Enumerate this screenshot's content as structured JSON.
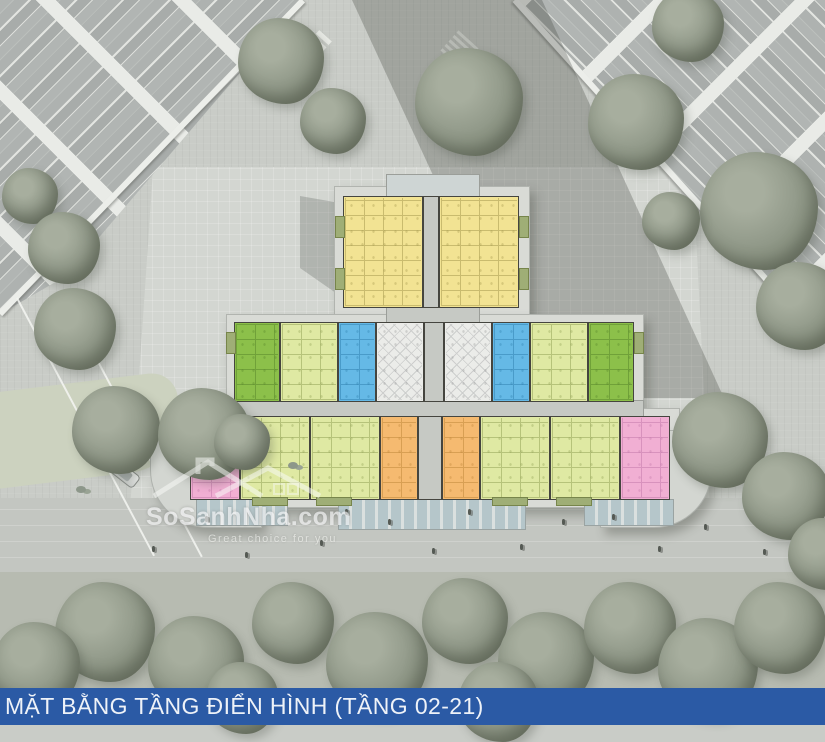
{
  "image_type": "architectural site plan rendering (aerial view)",
  "caption": {
    "label": "MẶT BẰNG TẦNG ĐIỂN HÌNH (TẦNG 02-21)",
    "bar_color": "#2b5aa5",
    "text_color": "#eef2f8"
  },
  "watermark": {
    "brand": "SoSanhNha.com",
    "tagline": "Great choice for you"
  },
  "colors": {
    "paving": "#c9ccc7",
    "plaza": "#d3d6d1",
    "plinth": "#d9dbd6",
    "corridor": "#c6c9c4",
    "canopy": "#ced5d4",
    "wall": "#45453f",
    "roof_grey": "#b1b5b3",
    "roof_trim": "#e9ebe7",
    "lawn": "#ccd2bf",
    "tree": "#939b8b",
    "tower_shadow": "rgba(56,60,54,0.28)"
  },
  "floor_plan": {
    "unit_colors": {
      "yellow": "#f2e393",
      "lime": "#8cc04a",
      "green": "#dfe9a3",
      "blue": "#65b9e6",
      "pink": "#f1afd3",
      "orange": "#f5ba70",
      "core": "#ebece9"
    },
    "unit_line_colors": {
      "yellow": "#a2954b",
      "lime": "#55832a",
      "green": "#8f9f52",
      "blue": "#2e7fae",
      "pink": "#c077a8",
      "orange": "#bd8538",
      "core": "#97999a"
    },
    "rows": {
      "top": [
        "yellow",
        "corridor",
        "yellow"
      ],
      "middle": [
        "lime",
        "green",
        "blue",
        "core",
        "corridor",
        "core",
        "blue",
        "green",
        "lime"
      ],
      "bottom": [
        "pink",
        "green",
        "green",
        "orange",
        "corridor",
        "orange",
        "green",
        "green",
        "pink"
      ]
    }
  }
}
